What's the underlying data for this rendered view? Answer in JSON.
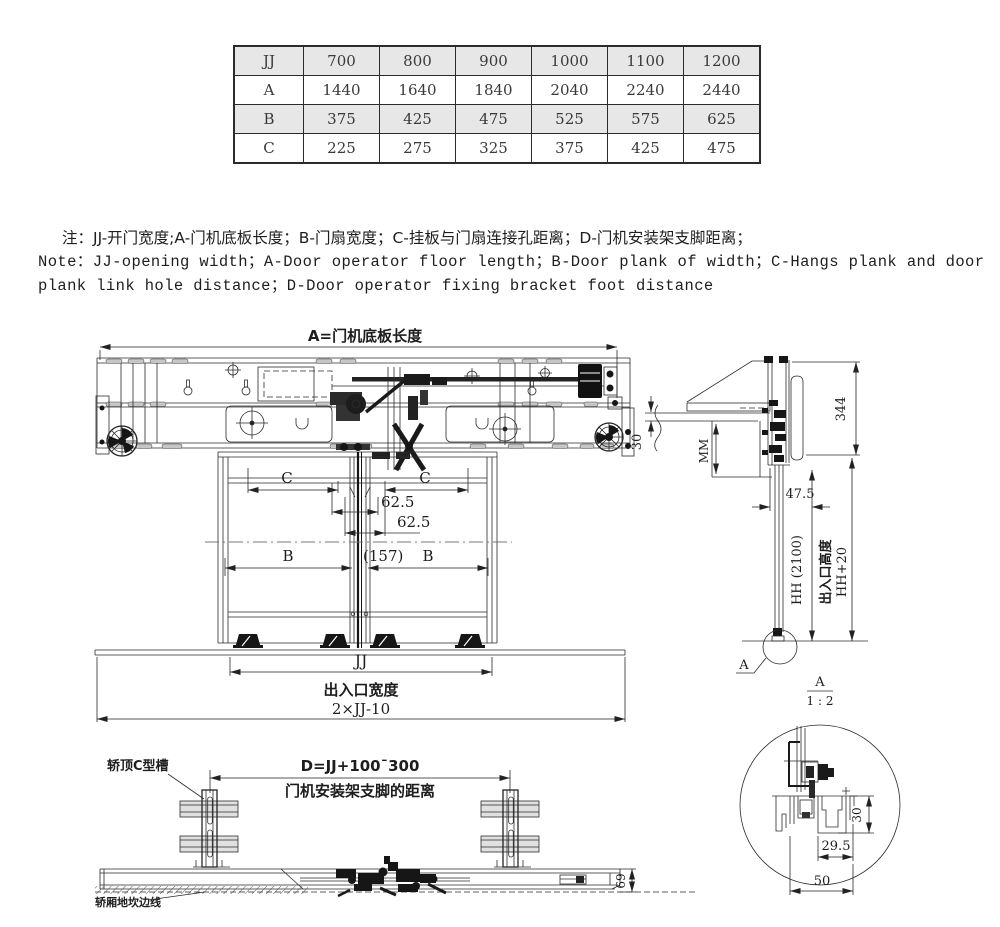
{
  "table": {
    "rows": [
      {
        "label": "JJ",
        "values": [
          "700",
          "800",
          "900",
          "1000",
          "1100",
          "1200"
        ],
        "shaded": true
      },
      {
        "label": "A",
        "values": [
          "1440",
          "1640",
          "1840",
          "2040",
          "2240",
          "2440"
        ],
        "shaded": false
      },
      {
        "label": "B",
        "values": [
          "375",
          "425",
          "475",
          "525",
          "575",
          "625"
        ],
        "shaded": true
      },
      {
        "label": "C",
        "values": [
          "225",
          "275",
          "325",
          "375",
          "425",
          "475"
        ],
        "shaded": false
      }
    ]
  },
  "notes": {
    "line1": "注：JJ-开门宽度;A-门机底板长度；B-门扇宽度；C-挂板与门扇连接孔距离；D-门机安装架支脚距离；",
    "line2": "Note：JJ-opening width；A-Door operator floor length；B-Door plank of width；C-Hangs plank and door",
    "line3": "plank link hole distance；D-Door operator fixing bracket foot distance"
  },
  "front_view": {
    "dim_a_label": "A=门机底板长度",
    "dim_c": "C",
    "dim_62_5": "62.5",
    "dim_b": "B",
    "dim_157": "(157)",
    "dim_jj": "JJ",
    "entrance_width_label": "出入口宽度",
    "dim_total_width": "2×JJ-10"
  },
  "side_view": {
    "dim_344": "344",
    "dim_30": "30",
    "dim_mm": "MM",
    "dim_47_5": "47.5",
    "dim_hh": "HH (2100)",
    "entrance_height_label": "出入口高度",
    "dim_hh_plus": "HH+20",
    "detail_label": "A",
    "detail_scale": "1 : 2"
  },
  "bottom_plan": {
    "car_top_channel_label": "轿顶C型槽",
    "dim_d": "D=JJ+100¯300",
    "bracket_distance_label": "门机安装架支脚的距离",
    "car_sill_edge_label": "轿厢地坎边线",
    "dim_69": "69"
  },
  "detail_a": {
    "dim_30": "30",
    "dim_29_5": "29.5",
    "dim_50": "50"
  },
  "colors": {
    "line": "#2b2b2b",
    "shaded_row": "#e7e7e7",
    "dark_part": "#161616"
  }
}
